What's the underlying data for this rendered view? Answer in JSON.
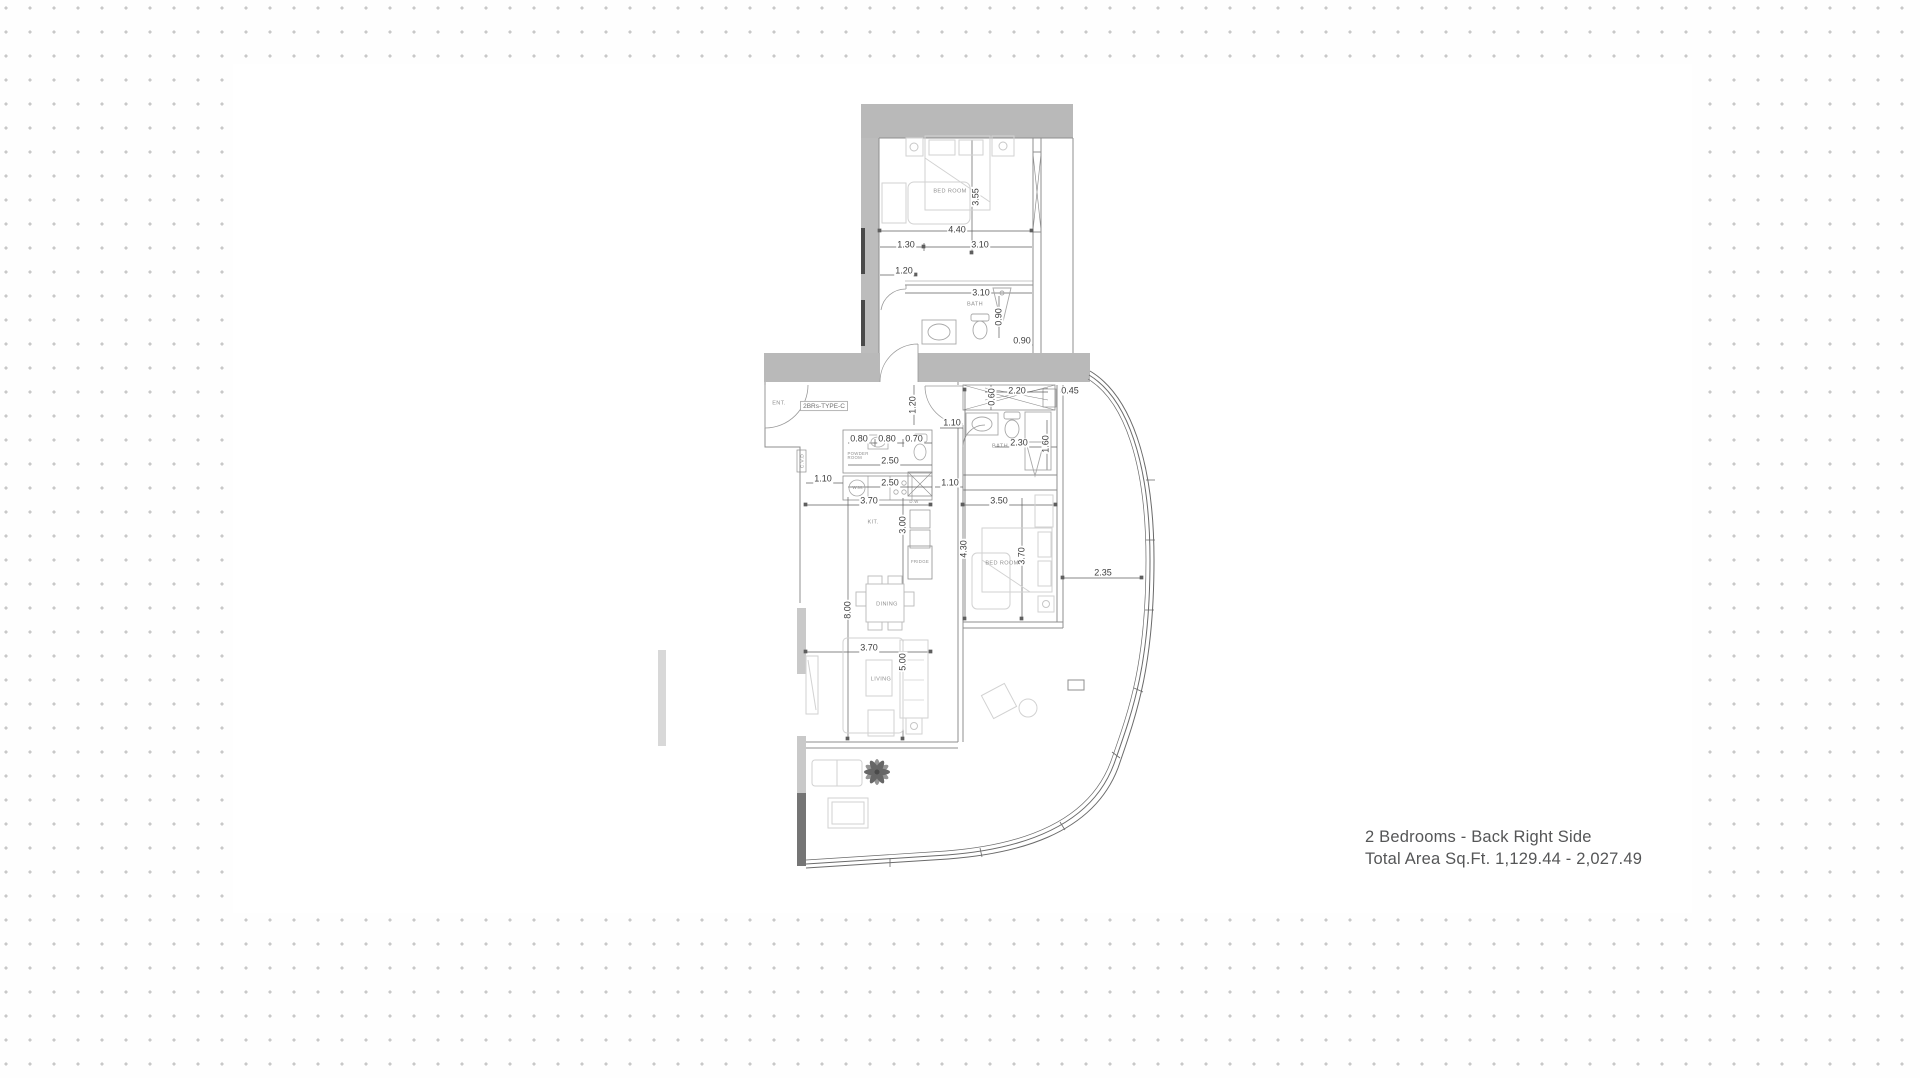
{
  "footer": {
    "line1": "2 Bedrooms - Back Right Side",
    "line2": "Total Area Sq.Ft. 1,129.44 - 2,027.49"
  },
  "plan": {
    "unit_type": "2BRs-TYPE-C",
    "labels": {
      "bedroom1": "BED ROOM",
      "bath1": "BATH",
      "bath2": "BATH",
      "bedroom2": "BED ROOM",
      "ent": "ENT.",
      "powder_room": "POWDER ROOM",
      "wm": "W.M.",
      "dw": "D.W",
      "kit": "KIT.",
      "fridge": "FRIDGE",
      "dining": "DINING",
      "living": "LIVING",
      "duct": "C.V.D"
    },
    "dimensions": {
      "d355v": "3.55",
      "d440": "4.40",
      "d130": "1.30",
      "d310a": "3.10",
      "d120a": "1.20",
      "d310b": "3.10",
      "d090v": "0.90",
      "d090h": "0.90",
      "d120v": "1.20",
      "d220": "2.20",
      "d060v": "0.60",
      "d045": "0.45",
      "d110a": "1.10",
      "d080a": "0.80",
      "d080b": "0.80",
      "d070": "0.70",
      "d250a": "2.50",
      "d110b": "1.10",
      "d250b": "2.50",
      "d110c": "1.10",
      "d370a": "3.70",
      "d350": "3.50",
      "d300v": "3.00",
      "d430v": "4.30",
      "d370bv": "3.70",
      "d800v": "8.00",
      "d235": "2.35",
      "d230": "2.30",
      "d160v": "1.60",
      "d370c": "3.70",
      "d500v": "5.00"
    },
    "colors": {
      "wall_gray": "#b9b9b9",
      "wall_dark": "#4a4a4a",
      "line_gray": "#8f8f8f",
      "furniture_gray": "#d6d6d6",
      "dimension_text": "#3d3d3d",
      "room_text": "#8f8f8f",
      "footer_text": "#555657",
      "background_dot": "#c8c8c8"
    }
  }
}
